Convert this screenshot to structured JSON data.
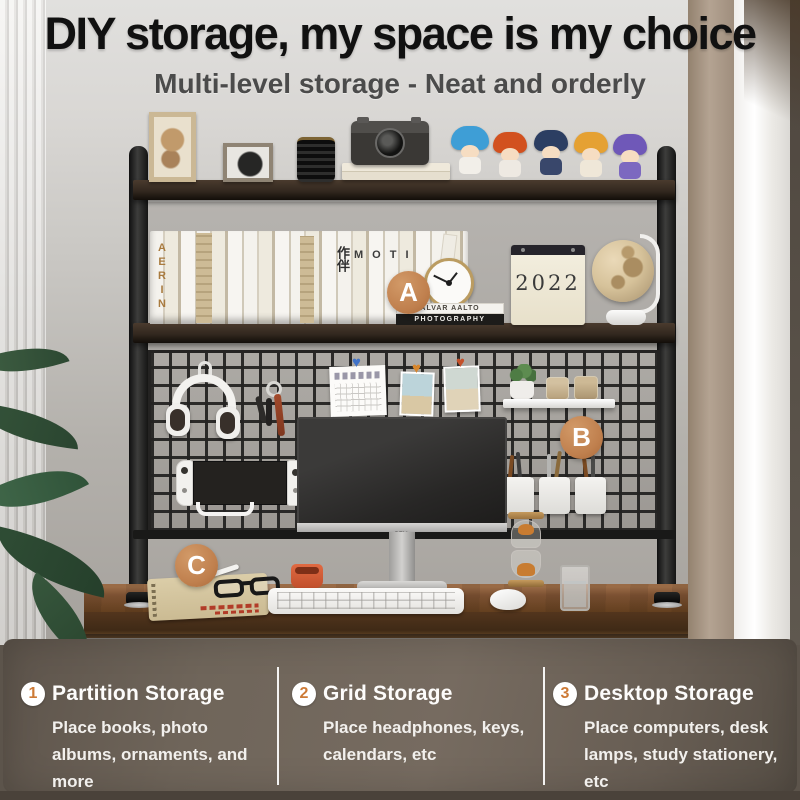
{
  "header": {
    "title": "DIY storage, my space is my choice",
    "subtitle": "Multi-level storage - Neat and orderly"
  },
  "callouts": {
    "a": "A",
    "b": "B",
    "c": "C"
  },
  "photo_text": {
    "book_spine_vertical": "AERIN",
    "book_spine_chinese": "作伴",
    "book_spine_letters": "MOTI",
    "book_stack_top": "ALVAR AALTO",
    "book_stack_bottom": "PHOTOGRAPHY",
    "calendar_year": "2022",
    "monitor_brand": "DELL"
  },
  "features": [
    {
      "number": "1",
      "title": "Partition Storage",
      "description": "Place books, photo albums, ornaments, and more"
    },
    {
      "number": "2",
      "title": "Grid Storage",
      "description": "Place headphones, keys, calendars, etc"
    },
    {
      "number": "3",
      "title": "Desktop Storage",
      "description": "Place computers, desk lamps, study stationery, etc"
    }
  ],
  "colors": {
    "badge": "#c0804e",
    "number": "#cd7a36",
    "panel_bg": "#6a6055",
    "panel_text": "#f2f0ed",
    "title": "#111111",
    "subtitle": "#4b4b4b"
  }
}
